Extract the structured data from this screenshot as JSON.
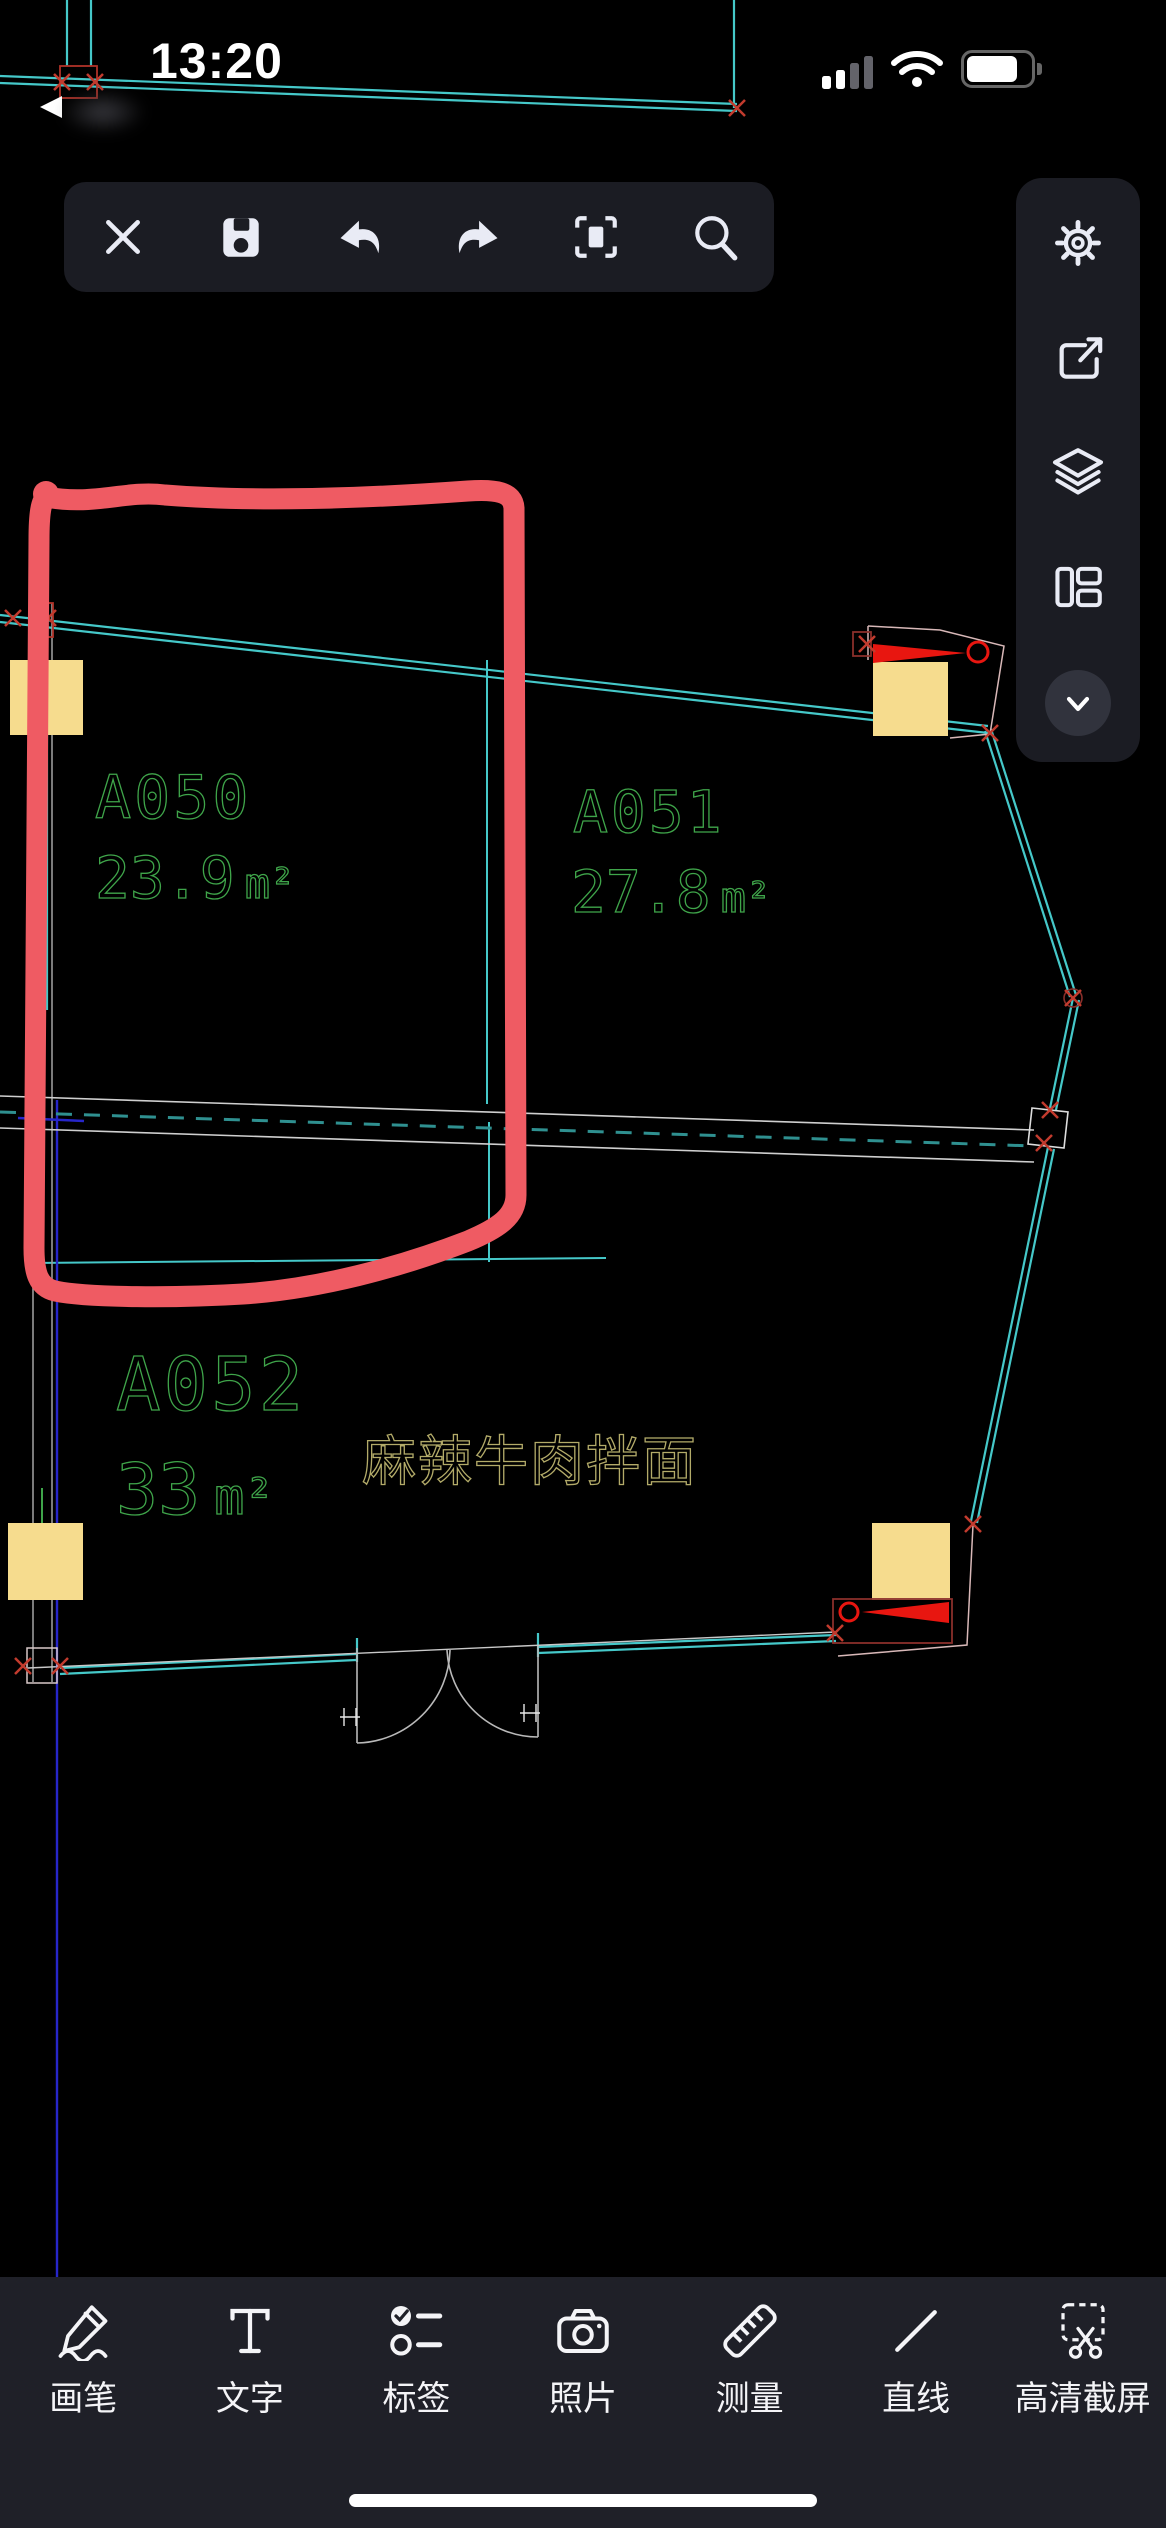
{
  "status_bar": {
    "time": "13:20",
    "icons": [
      "cellular-signal-icon",
      "wifi-icon",
      "battery-icon"
    ]
  },
  "top_toolbar": {
    "items": [
      {
        "icon": "close-icon"
      },
      {
        "icon": "save-icon"
      },
      {
        "icon": "undo-icon"
      },
      {
        "icon": "redo-icon"
      },
      {
        "icon": "fit-view-icon"
      },
      {
        "icon": "search-icon"
      }
    ]
  },
  "right_panel": {
    "items": [
      {
        "icon": "settings-gear-icon"
      },
      {
        "icon": "share-icon"
      },
      {
        "icon": "layers-icon"
      },
      {
        "icon": "layout-viewports-icon"
      },
      {
        "icon": "collapse-chevron-icon"
      }
    ]
  },
  "bottom_toolbar": {
    "items": [
      {
        "label": "画笔",
        "icon": "brush-icon"
      },
      {
        "label": "文字",
        "icon": "text-icon"
      },
      {
        "label": "标签",
        "icon": "tag-checklist-icon"
      },
      {
        "label": "照片",
        "icon": "photo-camera-icon"
      },
      {
        "label": "测量",
        "icon": "measure-ruler-icon"
      },
      {
        "label": "直线",
        "icon": "straight-line-icon"
      },
      {
        "label": "高清截屏",
        "icon": "hd-screenshot-icon"
      }
    ]
  },
  "drawing": {
    "rooms": [
      {
        "id": "A050",
        "area": "23.9",
        "unit": "m²"
      },
      {
        "id": "A051",
        "area": "27.8",
        "unit": "m²"
      },
      {
        "id": "A052",
        "area": "33",
        "unit": "m²"
      }
    ],
    "note": "麻辣牛肉拌面",
    "colors": {
      "wall": "#45c8c9",
      "room_text": "#3fa54a",
      "note_text": "#b3ab69",
      "column_fill": "#f6dc8e",
      "door_red": "#e81610",
      "marker_red": "#c23b2e",
      "annotation": "#ef5b63",
      "panel_bg": "#1b1c23",
      "bottombar_bg": "#1f2028"
    }
  }
}
